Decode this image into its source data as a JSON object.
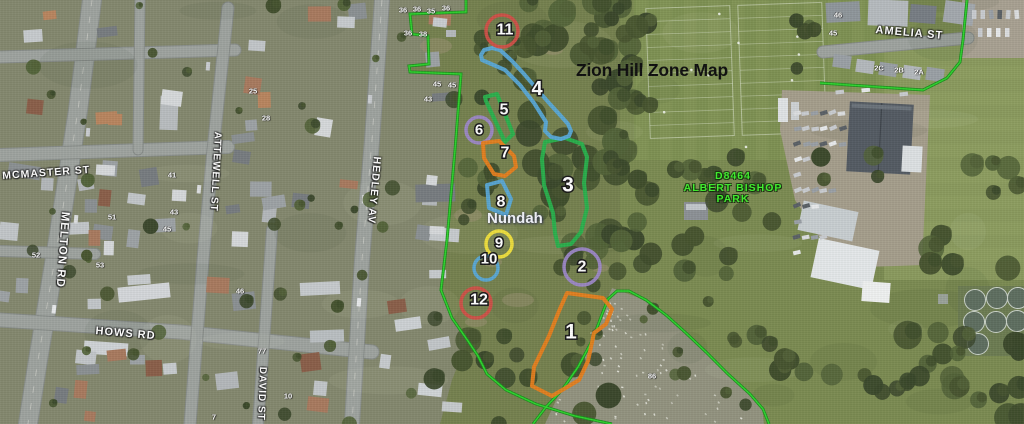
{
  "map": {
    "title": "Zion Hill Zone Map",
    "suburb_label": "Nundah",
    "park_label": {
      "lines": [
        "D8464",
        "ALBERT BISHOP",
        "PARK"
      ],
      "color": "#41f02e"
    },
    "boundary_color": "#2fd42f",
    "zone_colors": {
      "red": "#d05047",
      "blue": "#58a8d7",
      "green": "#28b14c",
      "purple": "#9c87c7",
      "orange": "#e67e1e",
      "yellow": "#f2e23c"
    },
    "streets": [
      {
        "id": "mcmaster",
        "label": "MCMASTER ST"
      },
      {
        "id": "melton",
        "label": "MELTON RD"
      },
      {
        "id": "attewell",
        "label": "ATTEWELL ST"
      },
      {
        "id": "hedley",
        "label": "HEDLEY AV"
      },
      {
        "id": "hows",
        "label": "HOWS RD"
      },
      {
        "id": "david",
        "label": "DAVID ST"
      },
      {
        "id": "amelia",
        "label": "AMELIA ST"
      }
    ],
    "zones": [
      {
        "n": "1",
        "color": "orange",
        "type": "poly",
        "fs": 21,
        "label": [
          571,
          332
        ],
        "points": [
          [
            567,
            293
          ],
          [
            603,
            298
          ],
          [
            612,
            309
          ],
          [
            606,
            324
          ],
          [
            594,
            333
          ],
          [
            588,
            361
          ],
          [
            579,
            380
          ],
          [
            552,
            396
          ],
          [
            532,
            386
          ],
          [
            534,
            367
          ],
          [
            549,
            336
          ],
          [
            559,
            311
          ]
        ]
      },
      {
        "n": "2",
        "color": "purple",
        "type": "circle",
        "fs": 16,
        "cx": 582,
        "cy": 267,
        "r": 18,
        "label": [
          582,
          267
        ]
      },
      {
        "n": "3",
        "color": "green",
        "type": "poly",
        "fs": 21,
        "label": [
          568,
          185
        ],
        "points": [
          [
            545,
            142
          ],
          [
            565,
            138
          ],
          [
            582,
            144
          ],
          [
            587,
            157
          ],
          [
            584,
            183
          ],
          [
            587,
            208
          ],
          [
            581,
            232
          ],
          [
            571,
            244
          ],
          [
            558,
            246
          ],
          [
            555,
            233
          ],
          [
            553,
            213
          ],
          [
            544,
            185
          ],
          [
            542,
            159
          ]
        ]
      },
      {
        "n": "4",
        "color": "blue",
        "type": "poly",
        "fs": 20,
        "label": [
          537,
          89
        ],
        "points": [
          [
            481,
            55
          ],
          [
            484,
            50
          ],
          [
            492,
            48
          ],
          [
            500,
            50
          ],
          [
            512,
            61
          ],
          [
            524,
            74
          ],
          [
            536,
            88
          ],
          [
            549,
            103
          ],
          [
            560,
            115
          ],
          [
            568,
            124
          ],
          [
            571,
            131
          ],
          [
            569,
            136
          ],
          [
            561,
            139
          ],
          [
            551,
            137
          ],
          [
            545,
            131
          ],
          [
            546,
            122
          ],
          [
            534,
            103
          ],
          [
            520,
            85
          ],
          [
            505,
            70
          ],
          [
            489,
            63
          ],
          [
            482,
            60
          ]
        ]
      },
      {
        "n": "5",
        "color": "green",
        "type": "poly",
        "fs": 16,
        "label": [
          504,
          110
        ],
        "points": [
          [
            485,
            97
          ],
          [
            497,
            94
          ],
          [
            513,
            134
          ],
          [
            505,
            142
          ],
          [
            486,
            101
          ]
        ]
      },
      {
        "n": "6",
        "color": "purple",
        "type": "circle",
        "fs": 15,
        "cx": 479,
        "cy": 130,
        "r": 13,
        "label": [
          479,
          130
        ]
      },
      {
        "n": "7",
        "color": "orange",
        "type": "poly",
        "fs": 16,
        "label": [
          505,
          153
        ],
        "points": [
          [
            483,
            143
          ],
          [
            499,
            141
          ],
          [
            514,
            156
          ],
          [
            516,
            167
          ],
          [
            505,
            176
          ],
          [
            494,
            174
          ],
          [
            484,
            158
          ]
        ]
      },
      {
        "n": "8",
        "color": "blue",
        "type": "poly",
        "fs": 16,
        "label": [
          501,
          202
        ],
        "points": [
          [
            487,
            185
          ],
          [
            502,
            181
          ],
          [
            511,
            199
          ],
          [
            506,
            215
          ],
          [
            489,
            208
          ]
        ]
      },
      {
        "n": "9",
        "color": "yellow",
        "type": "circle",
        "fs": 15,
        "cx": 499,
        "cy": 244,
        "r": 13,
        "label": [
          499,
          243
        ]
      },
      {
        "n": "10",
        "color": "blue",
        "type": "circle",
        "fs": 15,
        "cx": 486,
        "cy": 268,
        "r": 12,
        "label": [
          489,
          259
        ]
      },
      {
        "n": "11",
        "color": "red",
        "type": "circle",
        "fs": 16,
        "cx": 502,
        "cy": 31,
        "r": 16,
        "label": [
          505,
          30
        ]
      },
      {
        "n": "12",
        "color": "red",
        "type": "circle",
        "fs": 16,
        "cx": 476,
        "cy": 303,
        "r": 15,
        "label": [
          479,
          300
        ]
      }
    ],
    "house_numbers": [
      {
        "t": "36",
        "x": 403,
        "y": 10
      },
      {
        "t": "36",
        "x": 417,
        "y": 9
      },
      {
        "t": "35",
        "x": 431,
        "y": 11
      },
      {
        "t": "36",
        "x": 446,
        "y": 8
      },
      {
        "t": "36",
        "x": 408,
        "y": 33
      },
      {
        "t": "38",
        "x": 423,
        "y": 34
      },
      {
        "t": "45",
        "x": 437,
        "y": 84
      },
      {
        "t": "45",
        "x": 452,
        "y": 85
      },
      {
        "t": "43",
        "x": 428,
        "y": 99
      },
      {
        "t": "41",
        "x": 172,
        "y": 175
      },
      {
        "t": "43",
        "x": 174,
        "y": 212
      },
      {
        "t": "45",
        "x": 167,
        "y": 229
      },
      {
        "t": "51",
        "x": 112,
        "y": 217
      },
      {
        "t": "53",
        "x": 100,
        "y": 265
      },
      {
        "t": "52",
        "x": 36,
        "y": 255
      },
      {
        "t": "25",
        "x": 253,
        "y": 91
      },
      {
        "t": "28",
        "x": 266,
        "y": 118
      },
      {
        "t": "46",
        "x": 240,
        "y": 291
      },
      {
        "t": "77",
        "x": 262,
        "y": 351
      },
      {
        "t": "10",
        "x": 288,
        "y": 396
      },
      {
        "t": "7",
        "x": 214,
        "y": 417
      },
      {
        "t": "86",
        "x": 652,
        "y": 376
      },
      {
        "t": "46",
        "x": 838,
        "y": 15
      },
      {
        "t": "45",
        "x": 833,
        "y": 33
      },
      {
        "t": "2C",
        "x": 879,
        "y": 68
      },
      {
        "t": "2B",
        "x": 899,
        "y": 70
      },
      {
        "t": "2A",
        "x": 919,
        "y": 72
      }
    ]
  }
}
